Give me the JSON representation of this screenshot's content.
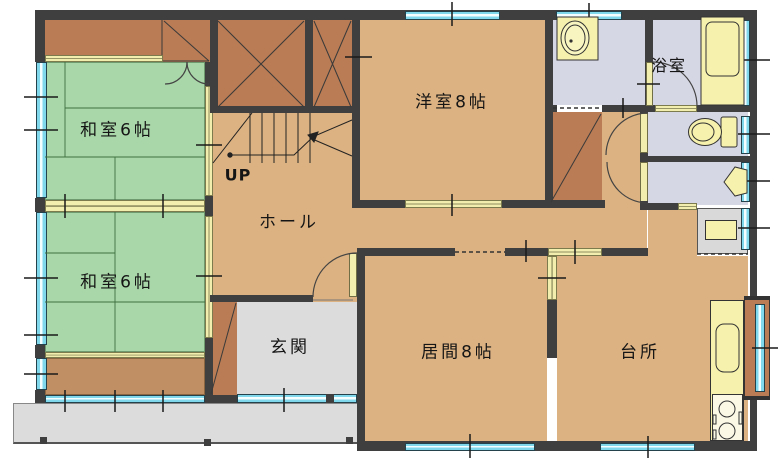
{
  "floorplan": {
    "labels": {
      "washitsu_top": "和室6帖",
      "washitsu_bottom": "和室6帖",
      "yoshitsu": "洋室8帖",
      "yokushitsu": "浴室",
      "hall": "ホール",
      "stairs_up": "UP",
      "genkan": "玄関",
      "ima": "居間8帖",
      "daidokoro": "台所"
    },
    "rooms": [
      {
        "id": "washitsu_top",
        "label": "和室6帖",
        "floor": "tatami"
      },
      {
        "id": "washitsu_bottom",
        "label": "和室6帖",
        "floor": "tatami"
      },
      {
        "id": "yoshitsu",
        "label": "洋室8帖",
        "floor": "wood"
      },
      {
        "id": "yokushitsu",
        "label": "浴室",
        "floor": "wet"
      },
      {
        "id": "hall",
        "label": "ホール",
        "floor": "wood"
      },
      {
        "id": "genkan",
        "label": "玄関",
        "floor": "tile"
      },
      {
        "id": "ima",
        "label": "居間8帖",
        "floor": "wood"
      },
      {
        "id": "daidokoro",
        "label": "台所",
        "floor": "wood"
      }
    ],
    "colors": {
      "wall": "#3f3f3f",
      "tatami_green": "#a9d7a9",
      "wood_floor": "#dcb282",
      "closet_brown": "#b97c55",
      "engawa_wood": "#c08f63",
      "wet_room_lavender": "#d6d7e5",
      "entrance_gray": "#dcdcdc",
      "window_cyan": "#7fd8ec",
      "fixture_yellow": "#f6f1ac",
      "opening_yellow": "#f2eeae"
    },
    "fixtures": [
      "vanity-sink",
      "bathtub",
      "toilet",
      "corner-hand-basin",
      "kitchen-counter",
      "kitchen-sink",
      "gas-stove",
      "bay-window",
      "shoe-cabinet",
      "utility-box",
      "staircase",
      "closets",
      "engawa-windows",
      "entrance-porch"
    ]
  }
}
